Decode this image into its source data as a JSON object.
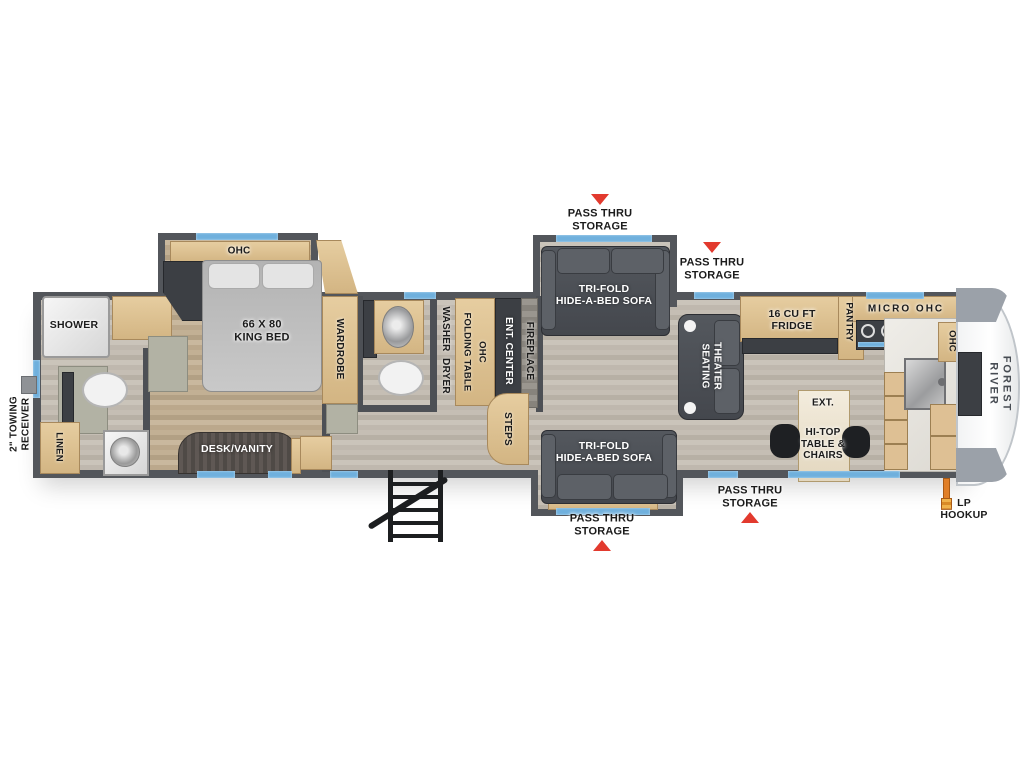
{
  "brand": {
    "logo_text": "FOREST RIVER"
  },
  "colors": {
    "wall": "#53565b",
    "window_accent": "#6fb0dd",
    "alert_red": "#e23a2e",
    "cabinet_tan": "#d9bd8f",
    "furniture_dark": "#4a4d52",
    "floor_light": "#c6c0b6",
    "floor_bedroom": "#c3b297",
    "lp_orange": "#e07f28"
  },
  "exterior": {
    "towing_receiver_label": "2\" TOWING\nRECEIVER",
    "lp_hookup_label": "LP\nHOOKUP",
    "pass_thru_top_left": "PASS THRU\nSTORAGE",
    "pass_thru_top_right": "PASS THRU\nSTORAGE",
    "pass_thru_bottom_center": "PASS THRU\nSTORAGE",
    "pass_thru_bottom_right": "PASS THRU\nSTORAGE"
  },
  "bathroom_rear": {
    "shower": "SHOWER",
    "linen": "LINEN"
  },
  "bedroom": {
    "ohc": "OHC",
    "bed": "66 X 80\nKING BED",
    "wardrobe": "WARDROBE",
    "desk_vanity": "DESK/VANITY"
  },
  "utility": {
    "washer": "WASHER",
    "dryer": "DRYER",
    "folding_table": "FOLDING TABLE",
    "ohc": "OHC",
    "steps": "STEPS"
  },
  "living": {
    "ent_center": "ENT. CENTER",
    "fireplace": "FIREPLACE",
    "sofa_top": "TRI-FOLD\nHIDE-A-BED SOFA",
    "sofa_bottom": "TRI-FOLD\nHIDE-A-BED SOFA",
    "theater_seating": "THEATER\nSEATING"
  },
  "kitchen": {
    "fridge": "16 CU FT\nFRIDGE",
    "pantry": "PANTRY",
    "micro_ohc": "MICRO OHC",
    "ohc": "OHC",
    "ext": "EXT.",
    "hitop_table": "HI-TOP\nTABLE &\nCHAIRS"
  }
}
